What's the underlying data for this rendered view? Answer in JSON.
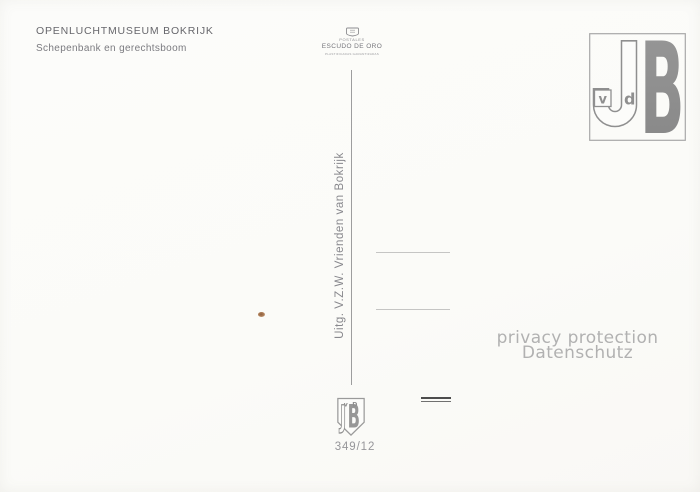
{
  "postcard": {
    "title": "OPENLUCHTMUSEUM BOKRIJK",
    "subtitle": "Schepenbank en gerechtsboom",
    "publisher": "Uitg. V.Z.W. Vrienden van Bokrijk",
    "series_number": "349/12"
  },
  "printer_logo": {
    "icon": "escudo-crest-icon",
    "top": "POSTALES",
    "name": "ESCUDO DE ORO",
    "fine_print": "PLASTIFICADAS GARANTIZADAS"
  },
  "stamp_box_monogram": {
    "j": "J",
    "v": "v",
    "d": "d",
    "b": "B"
  },
  "shield_monogram": {
    "v": "v",
    "d": "D",
    "j": "J",
    "b": "B"
  },
  "privacy_overlay": {
    "line1": "privacy protection",
    "line2": "Datenschutz"
  },
  "colors": {
    "background": "#fbfbf9",
    "title_ink": "#67676c",
    "subtitle_ink": "#7b7b80",
    "divider_gray": "#9d9d9e",
    "publisher_gray": "#88888d",
    "address_line_gray": "#c5c5c4",
    "monogram_gray": "#8f8f8f",
    "watermark_gray": "#b1b1b1",
    "postmark_dark": "#4d4d4d",
    "series_gray": "#96969a",
    "speck_brown": "#ad7e57"
  }
}
